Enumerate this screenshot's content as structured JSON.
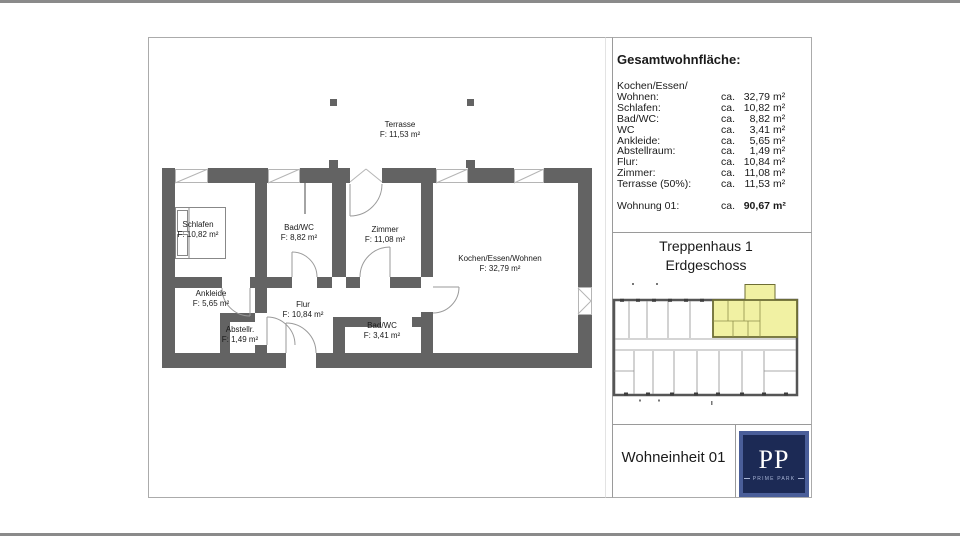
{
  "colors": {
    "wall": "#636363",
    "window_line": "#b5b5b5",
    "door_arc": "#9a9a9a",
    "highlight_yellow": "#f1f1a3",
    "highlight_border": "#6e6e35",
    "logo_frame_blue": "#4a5e99",
    "logo_navy": "#1c2a55",
    "sheet_border": "#ababab",
    "screen_bar": "#8a8a8a"
  },
  "floorplan": {
    "rooms": [
      {
        "name": "Terrasse",
        "area": "F: 11,53 m²"
      },
      {
        "name": "Schlafen",
        "area": "F: 10,82 m²"
      },
      {
        "name": "Bad/WC",
        "area": "F: 8,82 m²"
      },
      {
        "name": "Zimmer",
        "area": "F: 11,08 m²"
      },
      {
        "name": "Kochen/Essen/Wohnen",
        "area": "F: 32,79 m²"
      },
      {
        "name": "Ankleide",
        "area": "F: 5,65 m²"
      },
      {
        "name": "Flur",
        "area": "F: 10,84 m²"
      },
      {
        "name": "Abstellr.",
        "area": "F: 1,49 m²"
      },
      {
        "name": "Bad/WC",
        "area": "F: 3,41 m²"
      }
    ]
  },
  "panel": {
    "title": "Gesamtwohnfläche:",
    "rows": [
      {
        "label": "Kochen/Essen/",
        "ca": "",
        "num": "",
        "unit": ""
      },
      {
        "label": "Wohnen:",
        "ca": "ca.",
        "num": "32,79",
        "unit": "m²"
      },
      {
        "label": "Schlafen:",
        "ca": "ca.",
        "num": "10,82",
        "unit": "m²"
      },
      {
        "label": "Bad/WC:",
        "ca": "ca.",
        "num": "8,82",
        "unit": "m²"
      },
      {
        "label": "WC",
        "ca": "ca.",
        "num": "3,41",
        "unit": "m²"
      },
      {
        "label": "Ankleide:",
        "ca": "ca.",
        "num": "5,65",
        "unit": "m²"
      },
      {
        "label": "Abstellraum:",
        "ca": "ca.",
        "num": "1,49",
        "unit": "m²"
      },
      {
        "label": "Flur:",
        "ca": "ca.",
        "num": "10,84",
        "unit": "m²"
      },
      {
        "label": "Zimmer:",
        "ca": "ca.",
        "num": "11,08",
        "unit": "m²"
      },
      {
        "label": "Terrasse (50%):",
        "ca": "ca.",
        "num": "11,53",
        "unit": "m²"
      }
    ],
    "total": {
      "label": "Wohnung 01:",
      "ca": "ca.",
      "num": "90,67",
      "unit": "m²"
    },
    "staircase_line1": "Treppenhaus 1",
    "staircase_line2": "Erdgeschoss",
    "unit_label": "Wohneinheit 01",
    "logo": {
      "initials": "PP",
      "subtitle": "PRIME PARK"
    }
  }
}
